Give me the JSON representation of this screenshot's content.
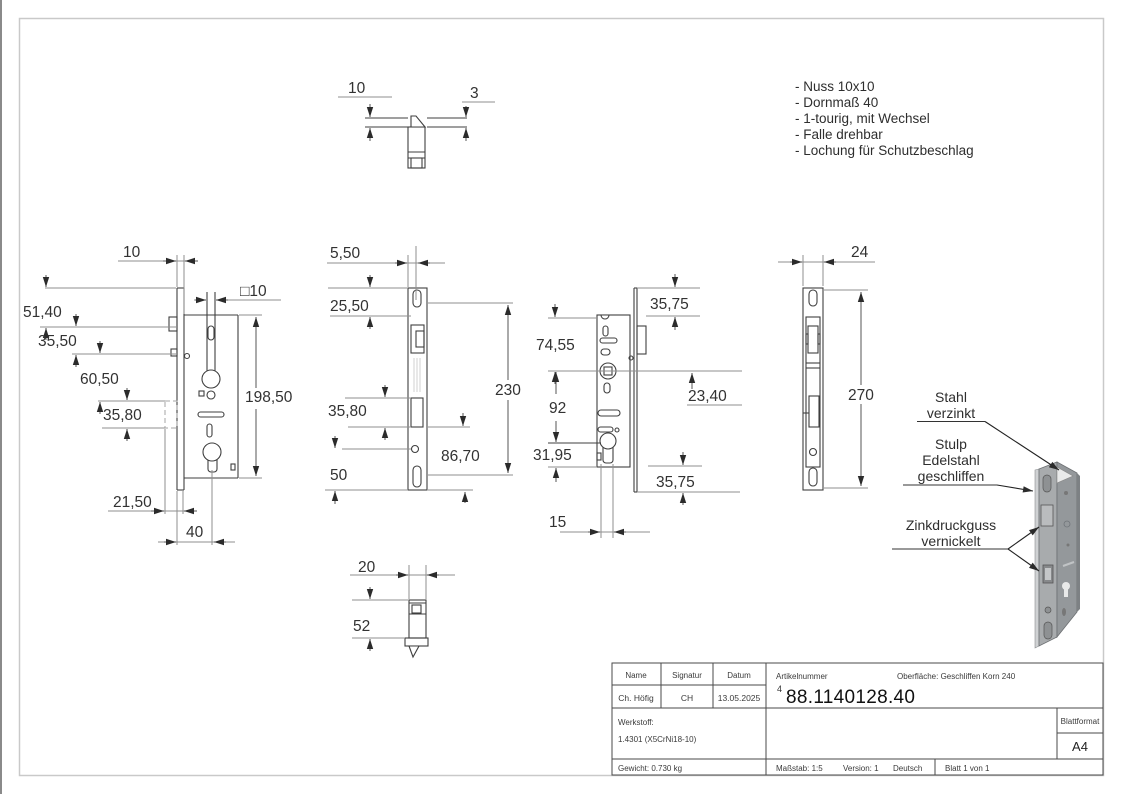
{
  "notes": {
    "items": [
      "- Nuss 10x10",
      "- Dornmaß 40",
      "- 1-tourig, mit Wechsel",
      "- Falle drehbar",
      "- Lochung für Schutzbeschlag"
    ]
  },
  "dims": {
    "top": {
      "plate_offset": "10",
      "thickness": "3"
    },
    "side": {
      "front_gap": "10",
      "spindle": "□10",
      "a": "51,40",
      "b": "35,50",
      "c": "60,50",
      "d": "35,80",
      "case_height": "198,50",
      "e": "21,50",
      "backset": "40"
    },
    "face": {
      "edge": "5,50",
      "a": "25,50",
      "bolt": "35,80",
      "b": "50",
      "length": "230",
      "c": "86,70"
    },
    "back": {
      "top": "35,75",
      "a": "74,55",
      "b": "23,40",
      "c": "92",
      "d": "31,95",
      "bottom": "35,75",
      "cyl": "15"
    },
    "strike": {
      "width": "24",
      "length": "270"
    },
    "bottom": {
      "width": "20",
      "depth": "52"
    }
  },
  "callouts": {
    "c1": {
      "line1": "Stahl",
      "line2": "verzinkt"
    },
    "c2": {
      "line1": "Stulp",
      "line2": "Edelstahl",
      "line3": "geschliffen"
    },
    "c3": {
      "line1": "Zinkdruckguss",
      "line2": "vernickelt"
    }
  },
  "titleblock": {
    "name_label": "Name",
    "signature_label": "Signatur",
    "date_label": "Datum",
    "name_value": "Ch. Höfig",
    "signature_value": "CH",
    "date_value": "13.05.2025",
    "article_label": "Artikelnummer",
    "surface_label": "Oberfläche:  Geschliffen Korn 240",
    "article_prefix": "4",
    "article_number": "88.1140128.40",
    "material_label": "Werkstoff:",
    "material_value": "1.4301  (X5CrNi18-10)",
    "sheet_format_label": "Blattformat",
    "sheet_format_value": "A4",
    "weight": "Gewicht: 0.730 kg",
    "scale": "Maßstab: 1:5",
    "version": "Version: 1",
    "language": "Deutsch",
    "sheet": "Blatt 1 von 1"
  },
  "colors": {
    "part_line": "#3f3f3f",
    "dim_line": "#8f8f8f",
    "sheet_border": "#c9c9c9",
    "iso_plate": "#a8abad",
    "iso_case": "#94989b"
  }
}
